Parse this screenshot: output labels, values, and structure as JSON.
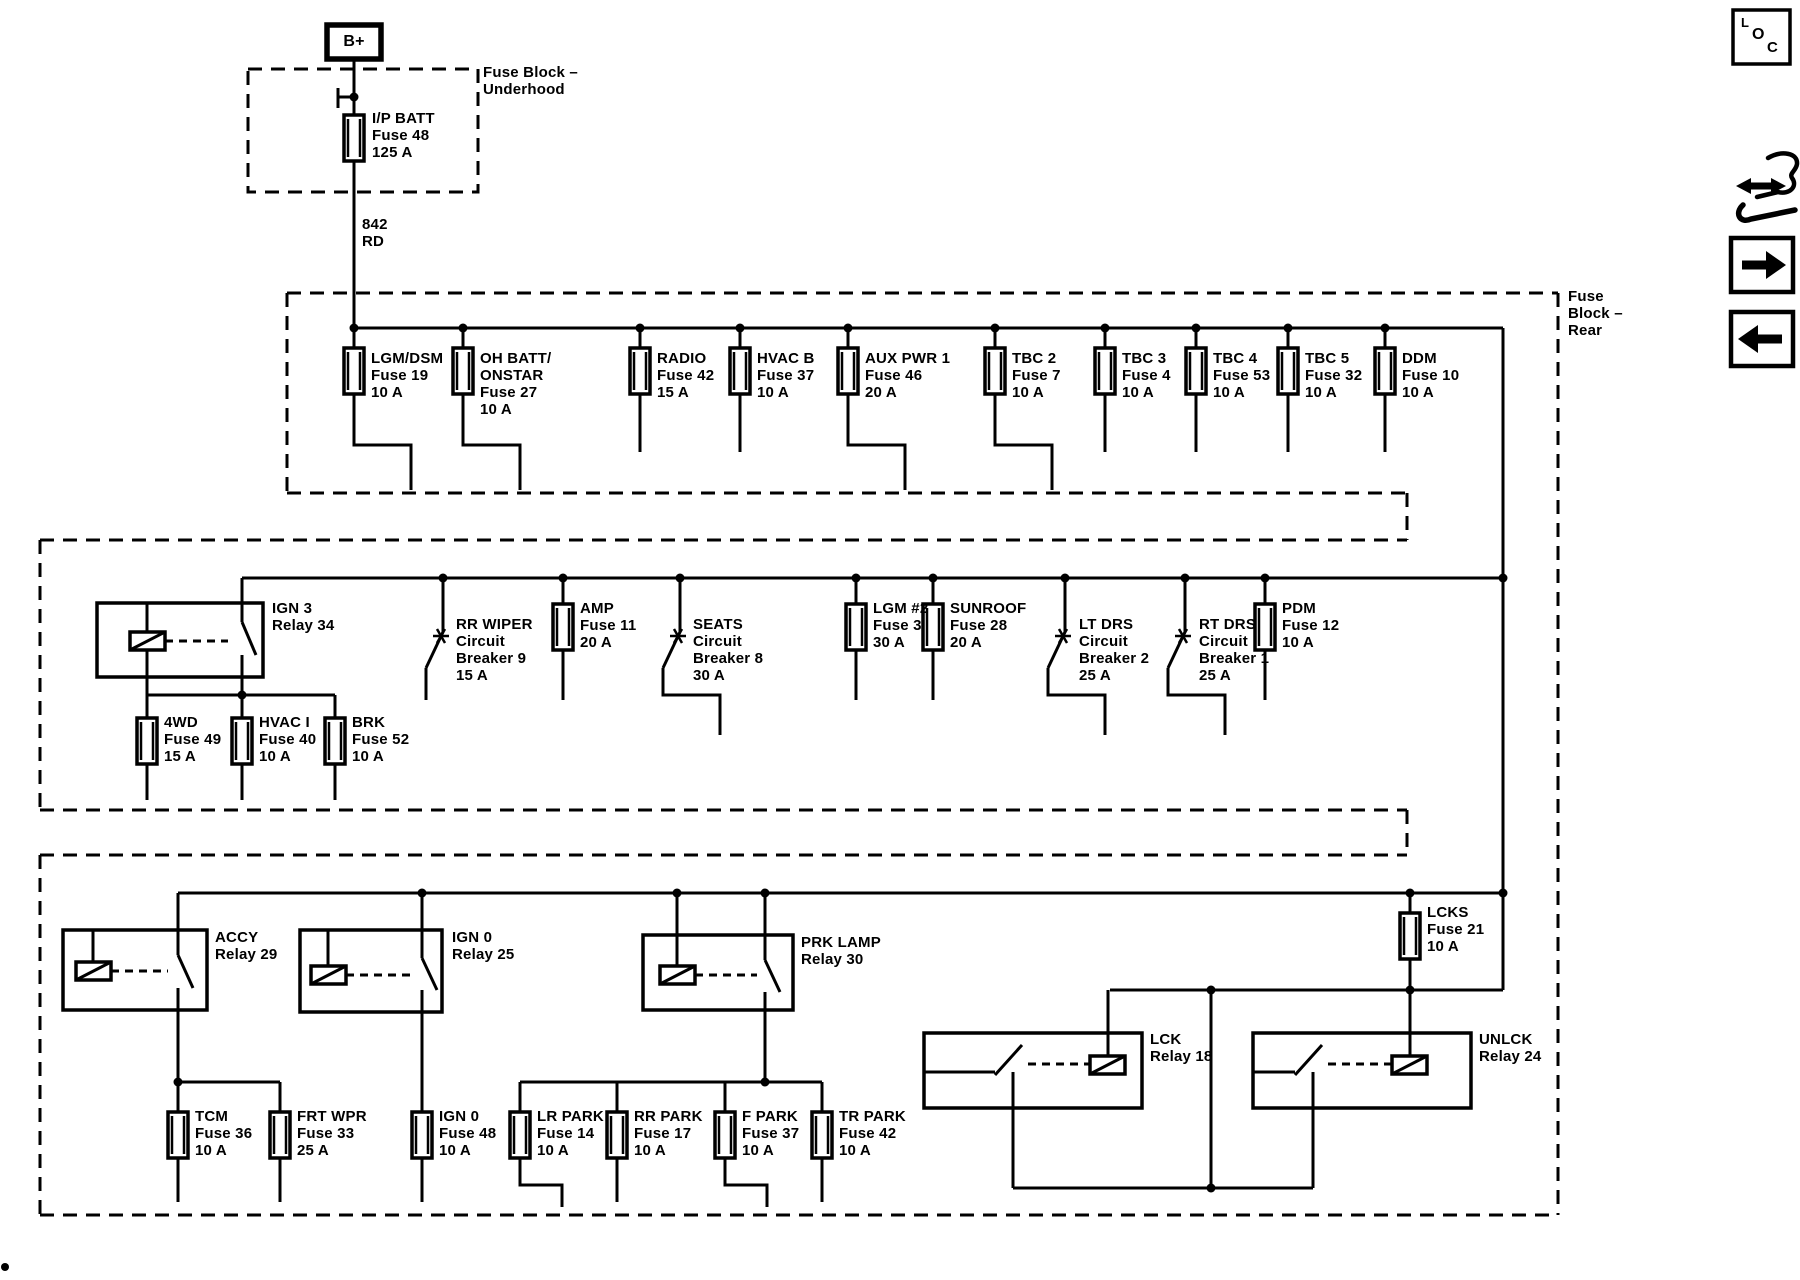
{
  "terminal": {
    "label": "B+"
  },
  "blocks": {
    "underhood": {
      "label_lines": [
        "Fuse Block –",
        "Underhood"
      ]
    },
    "rear": {
      "label_lines": [
        "Fuse",
        "Block –",
        "Rear"
      ]
    }
  },
  "feed_wire": {
    "lines": [
      "842",
      "RD"
    ]
  },
  "components": {
    "ip_batt": {
      "lines": [
        "I/P BATT",
        "Fuse 48",
        "125 A"
      ]
    },
    "row1": [
      {
        "id": "lgm-dsm",
        "lines": [
          "LGM/DSM",
          "Fuse 19",
          "10 A"
        ]
      },
      {
        "id": "oh-batt-onstar",
        "lines": [
          "OH BATT/",
          "ONSTAR",
          "Fuse 27",
          "10 A"
        ]
      },
      {
        "id": "radio",
        "lines": [
          "RADIO",
          "Fuse 42",
          "15 A"
        ]
      },
      {
        "id": "hvac-b",
        "lines": [
          "HVAC B",
          "Fuse 37",
          "10 A"
        ]
      },
      {
        "id": "aux-pwr-1",
        "lines": [
          "AUX PWR 1",
          "Fuse 46",
          "20 A"
        ]
      },
      {
        "id": "tbc-2",
        "lines": [
          "TBC 2",
          "Fuse 7",
          "10 A"
        ]
      },
      {
        "id": "tbc-3",
        "lines": [
          "TBC 3",
          "Fuse 4",
          "10 A"
        ]
      },
      {
        "id": "tbc-4",
        "lines": [
          "TBC 4",
          "Fuse 53",
          "10 A"
        ]
      },
      {
        "id": "tbc-5",
        "lines": [
          "TBC 5",
          "Fuse 32",
          "10 A"
        ]
      },
      {
        "id": "ddm",
        "lines": [
          "DDM",
          "Fuse 10",
          "10 A"
        ]
      }
    ],
    "ign3_relay": {
      "lines": [
        "IGN 3",
        "Relay 34"
      ]
    },
    "row2": [
      {
        "id": "rr-wiper",
        "lines": [
          "RR WIPER",
          "Circuit",
          "Breaker 9",
          "15 A"
        ]
      },
      {
        "id": "amp",
        "lines": [
          "AMP",
          "Fuse 11",
          "20 A"
        ]
      },
      {
        "id": "seats",
        "lines": [
          "SEATS",
          "Circuit",
          "Breaker 8",
          "30 A"
        ]
      },
      {
        "id": "lgm-2",
        "lines": [
          "LGM #2",
          "Fuse 3",
          "30 A"
        ]
      },
      {
        "id": "sunroof",
        "lines": [
          "SUNROOF",
          "Fuse 28",
          "20 A"
        ]
      },
      {
        "id": "lt-drs",
        "lines": [
          "LT DRS",
          "Circuit",
          "Breaker 2",
          "25 A"
        ]
      },
      {
        "id": "rt-drs",
        "lines": [
          "RT DRS",
          "Circuit",
          "Breaker 1",
          "25 A"
        ]
      },
      {
        "id": "pdm",
        "lines": [
          "PDM",
          "Fuse 12",
          "10 A"
        ]
      }
    ],
    "row2b": [
      {
        "id": "4wd",
        "lines": [
          "4WD",
          "Fuse 49",
          "15 A"
        ]
      },
      {
        "id": "hvac-i",
        "lines": [
          "HVAC I",
          "Fuse 40",
          "10 A"
        ]
      },
      {
        "id": "brk",
        "lines": [
          "BRK",
          "Fuse 52",
          "10 A"
        ]
      }
    ],
    "accy_relay": {
      "lines": [
        "ACCY",
        "Relay 29"
      ]
    },
    "ign0_relay": {
      "lines": [
        "IGN 0",
        "Relay 25"
      ]
    },
    "prk_lamp_relay": {
      "lines": [
        "PRK LAMP",
        "Relay 30"
      ]
    },
    "lck_relay": {
      "lines": [
        "LCK",
        "Relay 18"
      ]
    },
    "unlck_relay": {
      "lines": [
        "UNLCK",
        "Relay 24"
      ]
    },
    "lcks_fuse": {
      "lines": [
        "LCKS",
        "Fuse 21",
        "10 A"
      ]
    },
    "row4": [
      {
        "id": "tcm",
        "lines": [
          "TCM",
          "Fuse 36",
          "10 A"
        ]
      },
      {
        "id": "frt-wpr",
        "lines": [
          "FRT WPR",
          "Fuse 33",
          "25 A"
        ]
      },
      {
        "id": "ign-0",
        "lines": [
          "IGN 0",
          "Fuse 48",
          "10 A"
        ]
      },
      {
        "id": "lr-park",
        "lines": [
          "LR PARK",
          "Fuse 14",
          "10 A"
        ]
      },
      {
        "id": "rr-park",
        "lines": [
          "RR PARK",
          "Fuse 17",
          "10 A"
        ]
      },
      {
        "id": "f-park",
        "lines": [
          "F PARK",
          "Fuse 37",
          "10 A"
        ]
      },
      {
        "id": "tr-park",
        "lines": [
          "TR PARK",
          "Fuse 42",
          "10 A"
        ]
      }
    ]
  },
  "icons": {
    "loc_letters": [
      "L",
      "O",
      "C"
    ]
  },
  "colors": {
    "ink": "#000000",
    "paper": "#ffffff"
  }
}
